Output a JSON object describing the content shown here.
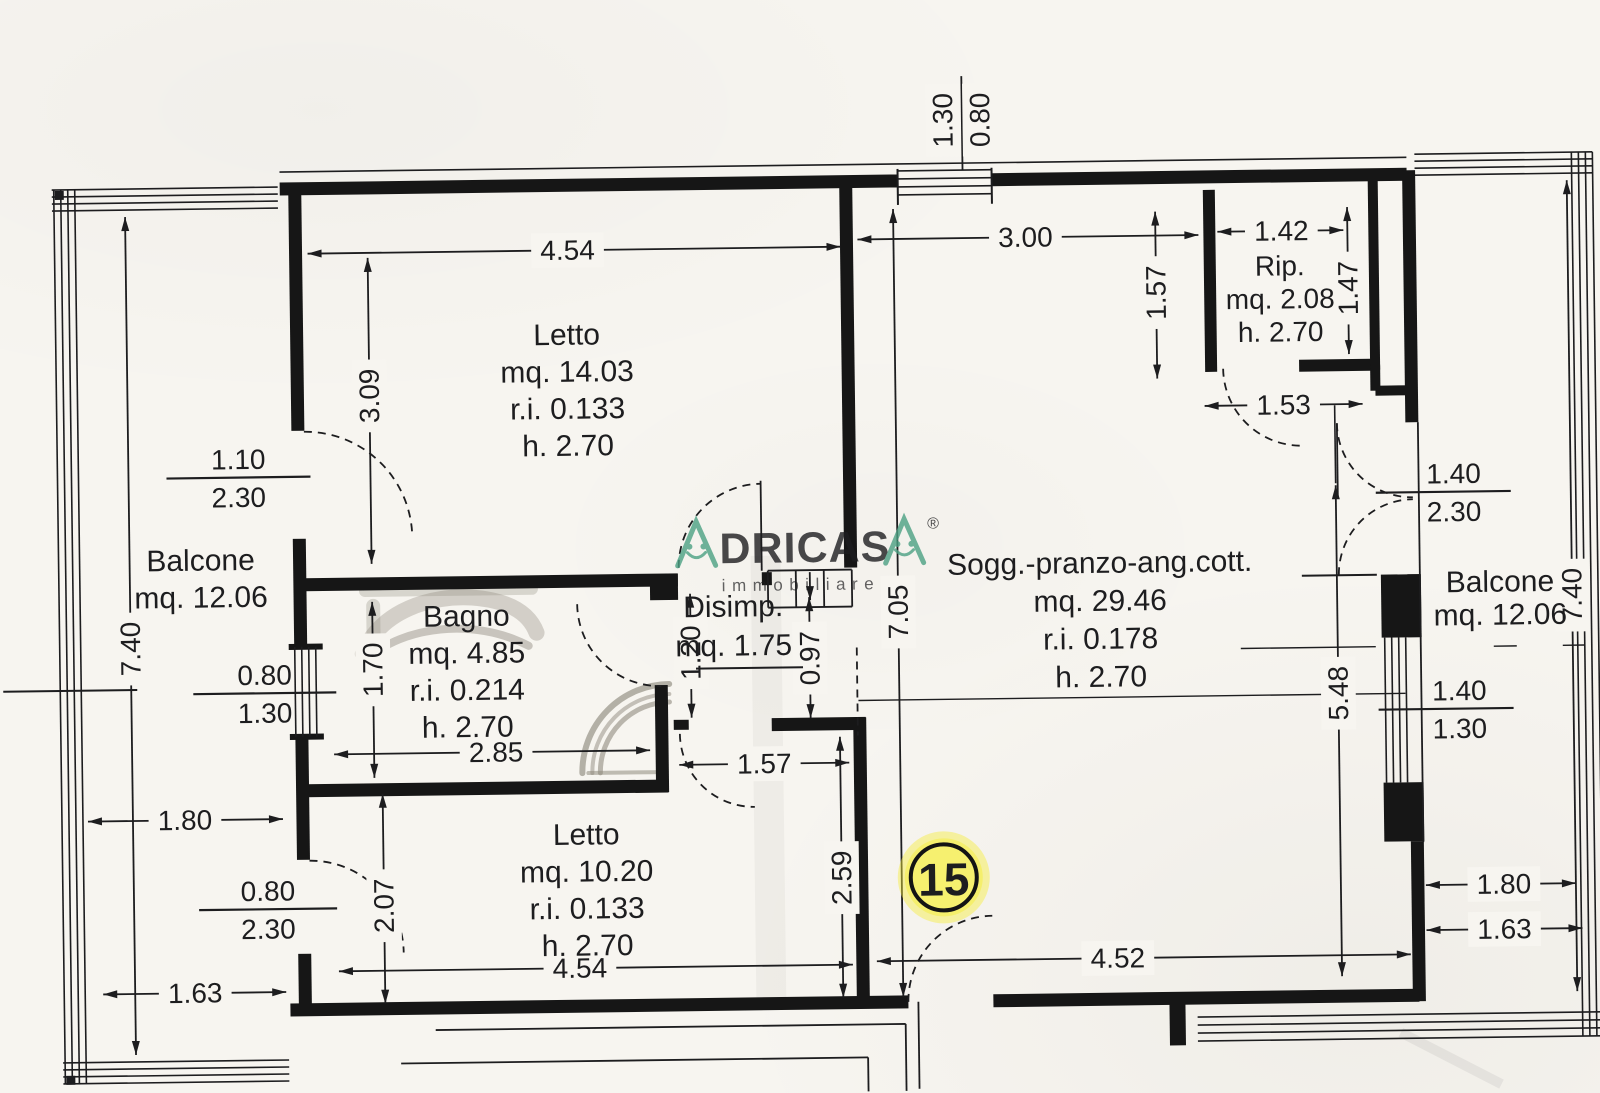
{
  "watermark": {
    "first_letter": "A",
    "mid": "DRICAS",
    "last_letter": "A",
    "registered": "®",
    "subtitle": "immobiliare"
  },
  "badge": {
    "number": "15"
  },
  "rooms": {
    "letto1": {
      "name": "Letto",
      "area": "mq. 14.03",
      "ratio": "r.i. 0.133",
      "height": "h. 2.70"
    },
    "bagno": {
      "name": "Bagno",
      "area": "mq. 4.85",
      "ratio": "r.i. 0.214",
      "height": "h. 2.70"
    },
    "disimp": {
      "name": "Disimp.",
      "area": "mq. 1.75"
    },
    "letto2": {
      "name": "Letto",
      "area": "mq. 10.20",
      "ratio": "r.i. 0.133",
      "height": "h. 2.70"
    },
    "soggiorno": {
      "name": "Sogg.-pranzo-ang.cott.",
      "area": "mq. 29.46",
      "ratio": "r.i. 0.178",
      "height": "h. 2.70"
    },
    "rip": {
      "name": "Rip.",
      "area": "mq. 2.08",
      "height": "h. 2.70"
    },
    "balcone_sx": {
      "name": "Balcone",
      "area": "mq. 12.06"
    },
    "balcone_dx": {
      "name": "Balcone",
      "area": "mq. 12.06"
    }
  },
  "dims": {
    "top_window_w": "0.80",
    "top_window_h": "1.30",
    "letto1_w": "4.54",
    "letto1_h": "3.09",
    "door_letto1_w": "1.10",
    "door_letto1_h": "2.30",
    "balcone_sx_h": "7.40",
    "window_sx_w": "0.80",
    "window_sx_h": "1.30",
    "balcone_sx_d": "1.80",
    "door_letto2_w": "0.80",
    "door_letto2_h": "2.30",
    "balcone_sx_w": "1.63",
    "bagno_h": "1.70",
    "bagno_w": "2.85",
    "disimp_h1": "1.20",
    "disimp_h2": "0.97",
    "disimp_w": "1.57",
    "letto2_h": "2.07",
    "letto2_w": "4.54",
    "letto2_h2": "2.59",
    "sogg_w_top": "3.00",
    "sogg_h": "7.05",
    "sogg_w": "4.52",
    "sogg_h2": "5.48",
    "rip_outside_h": "1.57",
    "rip_w": "1.42",
    "rip_h": "1.47",
    "rip_door_w": "1.53",
    "door_sogg_w": "1.40",
    "door_sogg_h": "2.30",
    "window_dx_w": "1.40",
    "window_dx_h": "1.30",
    "balcone_dx_h": "7.40",
    "balcone_dx_d": "1.80",
    "balcone_dx_w": "1.63"
  },
  "colors": {
    "paper": "#f7f5f0",
    "ink": "#1d1d1f",
    "wall": "#161616",
    "green": "#4ca183",
    "yellow": "#f6ee3c",
    "pencil": "#8f8a7e"
  }
}
